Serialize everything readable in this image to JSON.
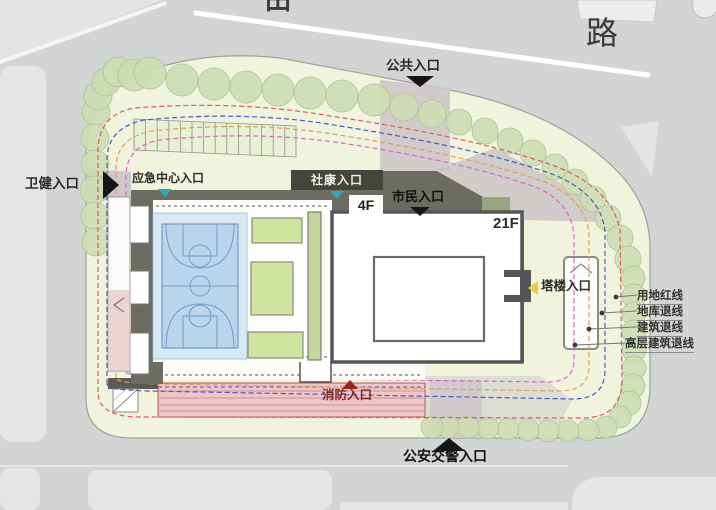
{
  "road": {
    "name": "路",
    "partial_char": "田"
  },
  "entrances": {
    "public": "公共入口",
    "health": "卫健入口",
    "emergency": "应急中心入口",
    "community": "社康入口",
    "citizen": "市民入口",
    "tower": "塔楼入口",
    "fire": "消防入口",
    "police": "公安交警入口"
  },
  "buildings": {
    "podium": "4F",
    "tower": "21F"
  },
  "legend": {
    "items": [
      {
        "label": "用地红线",
        "color": "#dd5a5a"
      },
      {
        "label": "地库退线",
        "color": "#4a58c0"
      },
      {
        "label": "建筑退线",
        "color": "#dfa055"
      },
      {
        "label": "高层建筑退线",
        "color": "#d965c8"
      }
    ]
  },
  "colors": {
    "road": "#d3d5d4",
    "sidewalk": "#e4e6e4",
    "lawn": "#f0f4dd",
    "tree": "#cddcb3",
    "podium_roof": "#6c6c63",
    "court": "#bad5eb",
    "fire_lane": "#eec5c8",
    "entry_arrow_teal": "#2fa9b6",
    "tower_arrow_yellow": "#e2ce3e"
  }
}
